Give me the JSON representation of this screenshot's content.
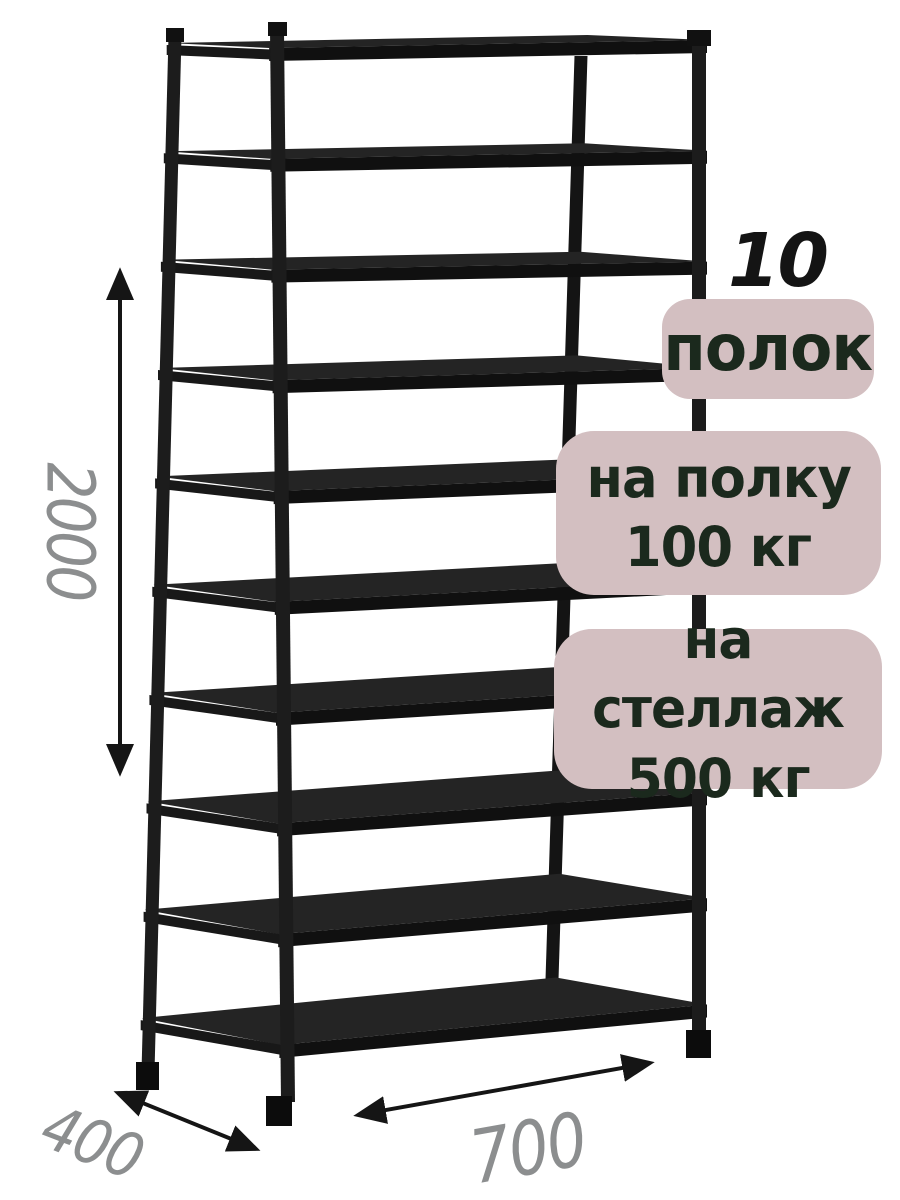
{
  "highlights": {
    "shelf_count_number": "10",
    "shelf_count_unit": "полок",
    "per_shelf": {
      "line1": "на полку",
      "line2": "100 кг"
    },
    "per_rack": {
      "line1": "на стеллаж",
      "line2": "500 кг"
    }
  },
  "dimensions": {
    "height": "2000",
    "depth": "400",
    "width": "700"
  },
  "rack": {
    "shelf_count": 10
  },
  "colors": {
    "background": "#ffffff",
    "rack_black": "#1b1b1b",
    "badge_bg": "#d3bfc1",
    "badge_text": "#1b291d",
    "dimension_text": "#8c8e8f",
    "arrow": "#151515"
  }
}
